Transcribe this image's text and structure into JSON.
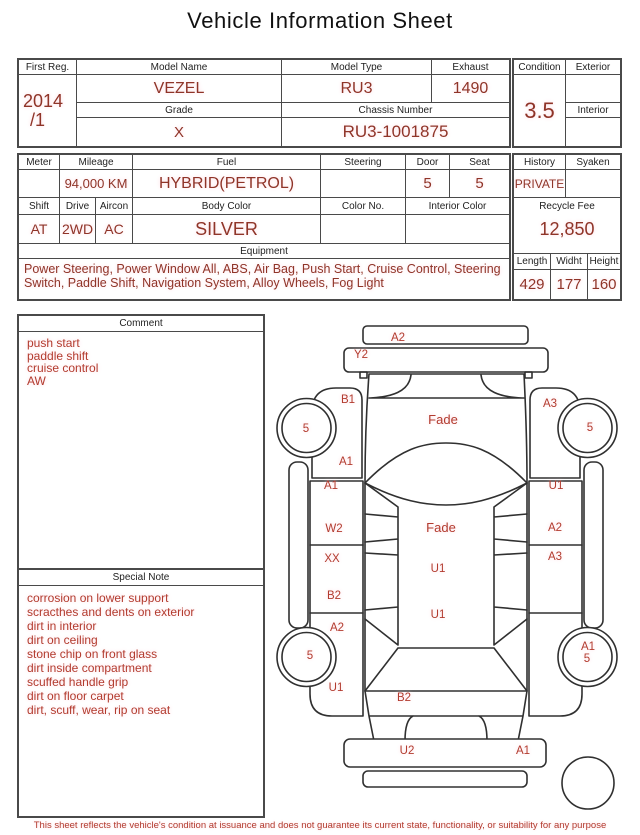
{
  "title": "Vehicle Information Sheet",
  "colors": {
    "value-red": "#8f3428",
    "note-red": "#b23b2e",
    "ink": "#1d1d1d",
    "line": "#4a4a4a",
    "stroke": "#303030",
    "halo": "#ffd6de"
  },
  "registration": {
    "first_reg_label": "First Reg.",
    "first_reg_line1": "2014",
    "first_reg_line2": "/1",
    "model_name_label": "Model Name",
    "model_name": "VEZEL",
    "model_type_label": "Model Type",
    "model_type": "RU3",
    "exhaust_label": "Exhaust",
    "exhaust": "1490",
    "grade_label": "Grade",
    "grade": "X",
    "chassis_number_label": "Chassis Number",
    "chassis_number": "RU3-1001875",
    "condition_label": "Condition",
    "condition_score": "3.5",
    "exterior_label": "Exterior",
    "exterior_grade": "",
    "interior_label": "Interior",
    "interior_grade": ""
  },
  "specs": {
    "meter_label": "Meter",
    "meter": "",
    "mileage_label": "Mileage",
    "mileage": "94,000 KM",
    "fuel_label": "Fuel",
    "fuel": "HYBRID(PETROL)",
    "steering_label": "Steering",
    "steering": "",
    "door_label": "Door",
    "door": "5",
    "seat_label": "Seat",
    "seat": "5",
    "shift_label": "Shift",
    "shift": "AT",
    "drive_label": "Drive",
    "drive": "2WD",
    "aircon_label": "Aircon",
    "aircon": "AC",
    "body_color_label": "Body Color",
    "body_color": "SILVER",
    "color_no_label": "Color No.",
    "color_no": "",
    "interior_color_label": "Interior Color",
    "interior_color": "",
    "equipment_label": "Equipment",
    "equipment": "Power Steering, Power Window  All, ABS, Air Bag, Push Start, Cruise Control, Steering Switch, Paddle Shift, Navigation System, Alloy Wheels, Fog Light",
    "history_label": "History",
    "history": "PRIVATE",
    "syaken_label": "Syaken",
    "syaken": "",
    "recycle_fee_label": "Recycle Fee",
    "recycle_fee": "12,850",
    "length_label": "Length",
    "length": "429",
    "width_label": "Widht",
    "width": "177",
    "height_label": "Height",
    "height": "160"
  },
  "comment": {
    "header": "Comment",
    "lines": [
      "push start",
      "paddle shift",
      "cruise control",
      "AW"
    ]
  },
  "special_note": {
    "header": "Special Note",
    "lines": [
      "corrosion on lower support",
      "scracthes and dents on exterior",
      "dirt in interior",
      "dirt on ceiling",
      "stone chip on front glass",
      "dirt inside compartment",
      "scuffed handle grip",
      "dirt on floor carpet",
      "dirt, scuff, wear, rip on seat"
    ]
  },
  "diagram": {
    "labels": [
      {
        "t": "A2",
        "x": 398,
        "y": 341
      },
      {
        "t": "Y2",
        "x": 361,
        "y": 358
      },
      {
        "t": "B1",
        "x": 348,
        "y": 403
      },
      {
        "t": "A3",
        "x": 550,
        "y": 407
      },
      {
        "t": "5",
        "x": 306,
        "y": 432
      },
      {
        "t": "5",
        "x": 590,
        "y": 431
      },
      {
        "t": "Fade",
        "x": 443,
        "y": 424,
        "big": true
      },
      {
        "t": "A1",
        "x": 346,
        "y": 465
      },
      {
        "t": "A1",
        "x": 331,
        "y": 489
      },
      {
        "t": "U1",
        "x": 556,
        "y": 489
      },
      {
        "t": "W2",
        "x": 334,
        "y": 532
      },
      {
        "t": "Fade",
        "x": 441,
        "y": 532,
        "big": true
      },
      {
        "t": "A2",
        "x": 555,
        "y": 531
      },
      {
        "t": "XX",
        "x": 332,
        "y": 562
      },
      {
        "t": "A3",
        "x": 555,
        "y": 560
      },
      {
        "t": "U1",
        "x": 438,
        "y": 572
      },
      {
        "t": "B2",
        "x": 334,
        "y": 599
      },
      {
        "t": "U1",
        "x": 438,
        "y": 618
      },
      {
        "t": "A2",
        "x": 337,
        "y": 631
      },
      {
        "t": "5",
        "x": 310,
        "y": 659
      },
      {
        "t": "A1",
        "x": 588,
        "y": 650
      },
      {
        "t": "5",
        "x": 587,
        "y": 662
      },
      {
        "t": "U1",
        "x": 336,
        "y": 691
      },
      {
        "t": "B2",
        "x": 404,
        "y": 701
      },
      {
        "t": "U2",
        "x": 407,
        "y": 754
      },
      {
        "t": "A1",
        "x": 523,
        "y": 754
      }
    ]
  },
  "footer": "This sheet reflects the vehicle's condition at issuance and does not guarantee its current state, functionality, or suitability for any purpose"
}
